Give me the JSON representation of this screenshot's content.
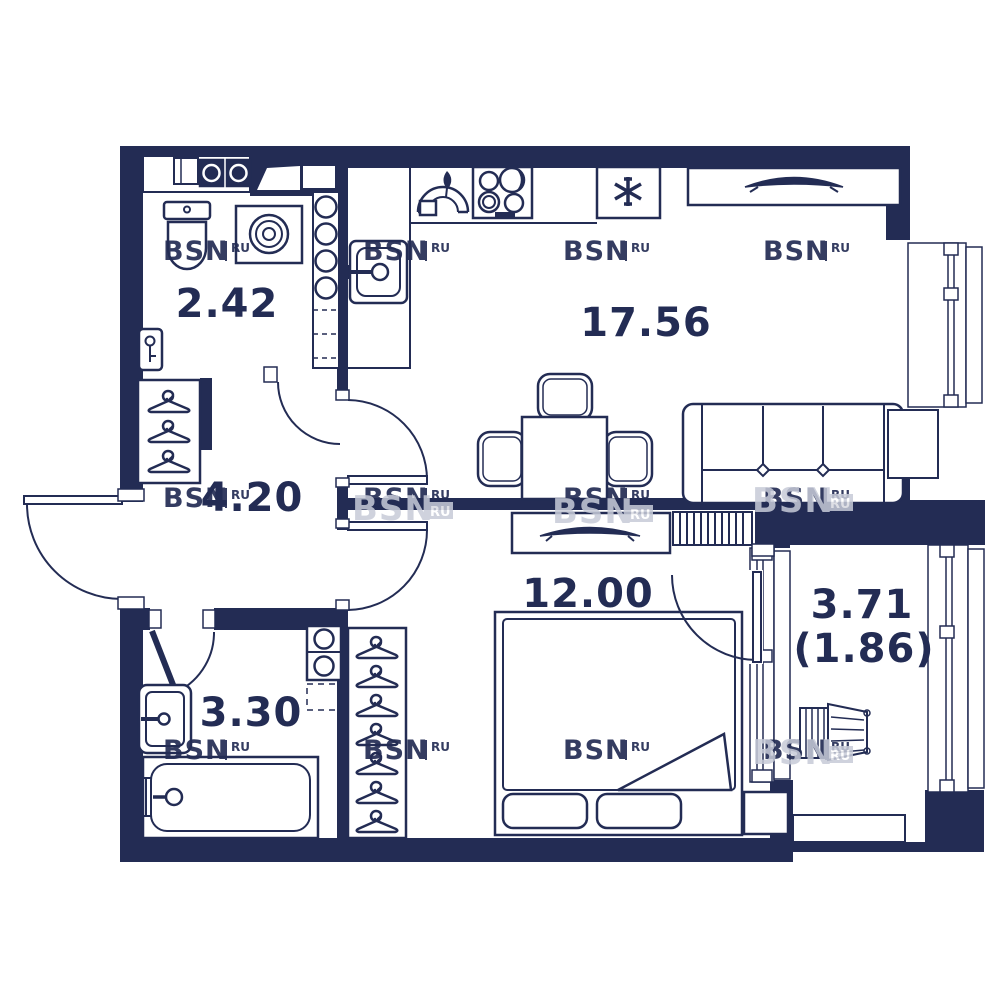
{
  "plan": {
    "brand": {
      "name": "BSN",
      "suffix": "RU"
    },
    "rooms": [
      {
        "id": "wc",
        "area": "2.42"
      },
      {
        "id": "kitchen-living",
        "area": "17.56"
      },
      {
        "id": "hallway",
        "area": "4.20"
      },
      {
        "id": "bedroom",
        "area": "12.00"
      },
      {
        "id": "bathroom",
        "area": "3.30"
      },
      {
        "id": "balcony",
        "area": "3.71",
        "area_reduced": "(1.86)"
      }
    ],
    "colors": {
      "wall": "#232c54",
      "background": "#ffffff",
      "watermark_light": "#c7cbd8"
    }
  }
}
